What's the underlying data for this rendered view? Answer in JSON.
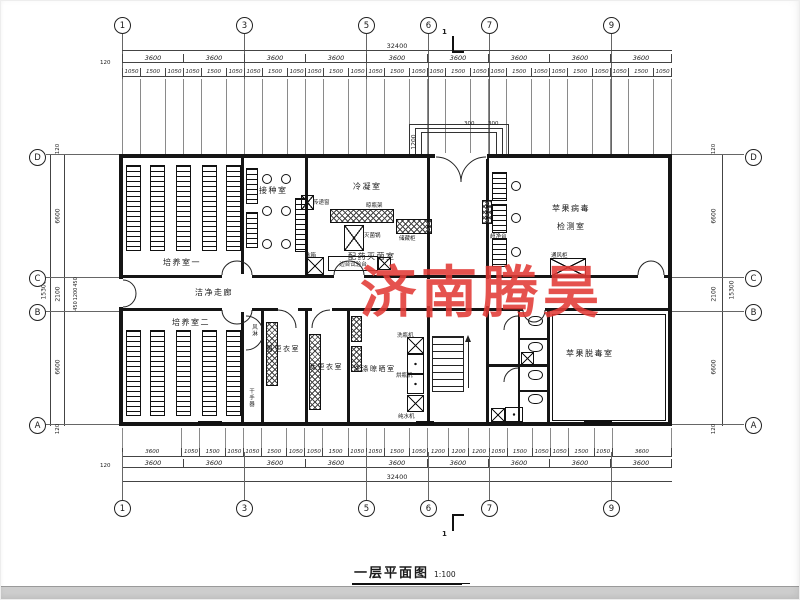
{
  "watermark": {
    "text": "济南腾昊",
    "color": "#e23b36"
  },
  "title": {
    "name": "一层平面图",
    "scale": "1:100"
  },
  "grid": {
    "top": [
      "1",
      "3",
      "5",
      "6",
      "7",
      "9"
    ],
    "bottom": [
      "1",
      "3",
      "5",
      "6",
      "7",
      "9"
    ],
    "left": [
      "D",
      "C",
      "B",
      "A"
    ],
    "right": [
      "D",
      "C",
      "B",
      "A"
    ]
  },
  "dims": {
    "total_w": "32400",
    "total_h": "15300",
    "offset": "120",
    "section": "1",
    "top_bays": [
      "3600",
      "3600",
      "3600",
      "3600",
      "3600",
      "3600",
      "3600",
      "3600",
      "3600"
    ],
    "top_sub": [
      "1050",
      "1500",
      "1050",
      "1050",
      "1500",
      "1050",
      "1050",
      "1500",
      "1050",
      "1050",
      "1500",
      "1050",
      "1050",
      "1500",
      "1050",
      "1050",
      "1500",
      "1050",
      "1050",
      "1500",
      "1050",
      "1050",
      "1500",
      "1050",
      "1050",
      "1500",
      "1050"
    ],
    "bottom_bays": [
      "3600",
      "3600",
      "3600",
      "3600",
      "3600",
      "3600",
      "3600",
      "3600",
      "3600"
    ],
    "bottom_sub": [
      "3600",
      "1050",
      "1500",
      "1050",
      "1050",
      "1500",
      "1050",
      "1050",
      "1500",
      "1050",
      "1050",
      "1500",
      "1050",
      "1200",
      "1200",
      "1200",
      "1050",
      "1500",
      "1050",
      "1050",
      "1500",
      "1050",
      "3600"
    ],
    "left_col": [
      "120",
      "6600",
      "2100",
      "6600",
      "120"
    ],
    "left_sub": [
      "450",
      "1200",
      "450"
    ],
    "right_col": [
      "120",
      "6600",
      "2100",
      "6600",
      "120"
    ],
    "canopy": {
      "d1": "1200",
      "d2": "300",
      "d3": "300"
    }
  },
  "rooms": {
    "culture1": "培养室一",
    "culture2": "培养室二",
    "inoculation": "接种室",
    "condensing": "冷凝室",
    "prep_steril": "配药灭菌室",
    "virus_test_l1": "苹果病毒",
    "virus_test_l2": "检测室",
    "clean_corridor": "洁净走廊",
    "men_change": "男更衣室",
    "women_change": "女更衣室",
    "washing": "洗涤晾晒室",
    "detox": "苹果脱毒室"
  },
  "equipment": {
    "pass_window": "传递窗",
    "sterilizer": "灭菌锅",
    "storage": "储藏柜",
    "bottle_rack": "晾瓶架",
    "fridge": "冰箱",
    "side_bench": "边台试验台",
    "clean_bench": "超净台",
    "fume_hood": "通风柜",
    "air_shower": "风淋",
    "hand_dryer": "干手器",
    "bottle_washer": "洗瓶机",
    "bottle_dryer": "烘瓶机",
    "water_purifier": "纯水机"
  }
}
